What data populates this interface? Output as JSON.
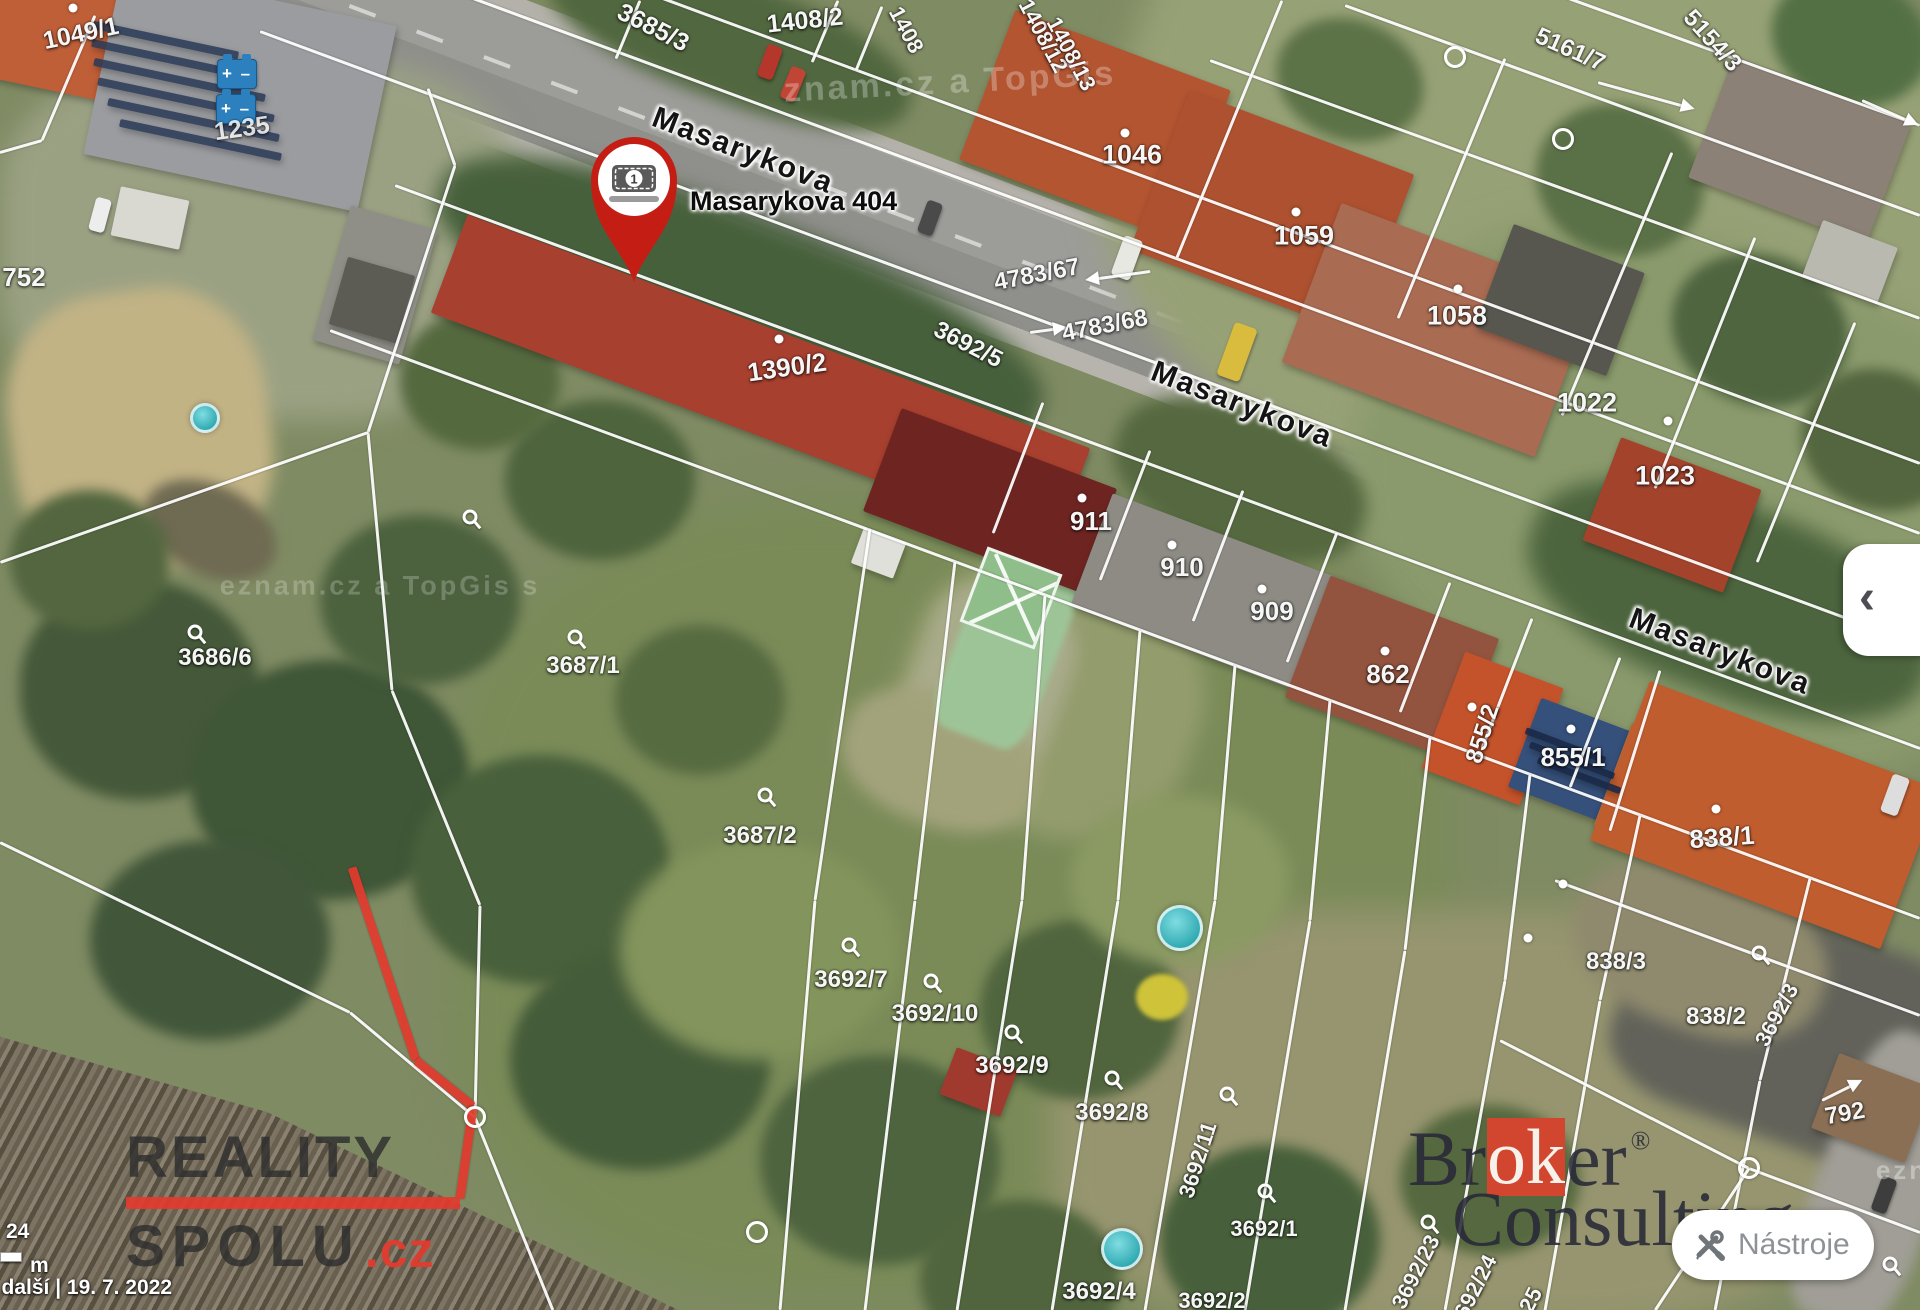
{
  "map": {
    "marker": {
      "badge": "1",
      "label": "Masarykova 404"
    },
    "street_labels": [
      {
        "t": "Masarykova",
        "x": 743,
        "y": 151,
        "r": 21,
        "s": 30
      },
      {
        "t": "Masarykova",
        "x": 1242,
        "y": 405,
        "r": 21,
        "s": 30
      },
      {
        "t": "Masarykova",
        "x": 1720,
        "y": 652,
        "r": 21,
        "s": 30
      }
    ],
    "parcel_labels": [
      {
        "t": "1049/1",
        "x": 81,
        "y": 34,
        "r": -12,
        "s": 25
      },
      {
        "t": "1235",
        "x": 242,
        "y": 129,
        "r": -8,
        "s": 25,
        "o": 0.85
      },
      {
        "t": "3685/3",
        "x": 653,
        "y": 28,
        "r": 27,
        "s": 25
      },
      {
        "t": "1408/2",
        "x": 805,
        "y": 21,
        "r": -6,
        "s": 25
      },
      {
        "t": "1408",
        "x": 906,
        "y": 30,
        "r": 62,
        "s": 22
      },
      {
        "t": "1408/12",
        "x": 1043,
        "y": 36,
        "r": 62,
        "s": 22
      },
      {
        "t": "1408/13",
        "x": 1071,
        "y": 54,
        "r": 62,
        "s": 22
      },
      {
        "t": "1046",
        "x": 1132,
        "y": 155,
        "r": 0,
        "s": 27
      },
      {
        "t": "1059",
        "x": 1304,
        "y": 236,
        "r": 0,
        "s": 27
      },
      {
        "t": "1058",
        "x": 1457,
        "y": 316,
        "r": 0,
        "s": 27
      },
      {
        "t": "1022",
        "x": 1587,
        "y": 403,
        "r": 0,
        "s": 27
      },
      {
        "t": "1023",
        "x": 1665,
        "y": 476,
        "r": 0,
        "s": 27
      },
      {
        "t": "5161/7",
        "x": 1570,
        "y": 50,
        "r": 24,
        "s": 24
      },
      {
        "t": "5154/3",
        "x": 1712,
        "y": 41,
        "r": 48,
        "s": 24
      },
      {
        "t": "752",
        "x": 24,
        "y": 277,
        "r": 0,
        "s": 26
      },
      {
        "t": "4783/67",
        "x": 1037,
        "y": 275,
        "r": -11,
        "s": 24
      },
      {
        "t": "4783/68",
        "x": 1105,
        "y": 326,
        "r": -11,
        "s": 24
      },
      {
        "t": "3692/5",
        "x": 968,
        "y": 345,
        "r": 27,
        "s": 24
      },
      {
        "t": "1390/2",
        "x": 787,
        "y": 367,
        "r": -8,
        "s": 26
      },
      {
        "t": "911",
        "x": 1091,
        "y": 521,
        "r": 0,
        "s": 26
      },
      {
        "t": "910",
        "x": 1182,
        "y": 567,
        "r": 0,
        "s": 26
      },
      {
        "t": "909",
        "x": 1272,
        "y": 611,
        "r": 0,
        "s": 26
      },
      {
        "t": "862",
        "x": 1388,
        "y": 674,
        "r": 0,
        "s": 26
      },
      {
        "t": "855/2",
        "x": 1483,
        "y": 734,
        "r": -72,
        "s": 24
      },
      {
        "t": "855/1",
        "x": 1573,
        "y": 757,
        "r": 0,
        "s": 26
      },
      {
        "t": "838/1",
        "x": 1722,
        "y": 837,
        "r": -4,
        "s": 26
      },
      {
        "t": "838/3",
        "x": 1616,
        "y": 962,
        "r": 0,
        "s": 24
      },
      {
        "t": "838/2",
        "x": 1716,
        "y": 1017,
        "r": 0,
        "s": 24
      },
      {
        "t": "3692/3",
        "x": 1777,
        "y": 1015,
        "r": -62,
        "s": 22
      },
      {
        "t": "792",
        "x": 1845,
        "y": 1114,
        "r": -10,
        "s": 24
      },
      {
        "t": "3687/1",
        "x": 583,
        "y": 666,
        "r": 0,
        "s": 24
      },
      {
        "t": "3686/6",
        "x": 215,
        "y": 658,
        "r": 0,
        "s": 24
      },
      {
        "t": "3687/2",
        "x": 760,
        "y": 836,
        "r": 0,
        "s": 24
      },
      {
        "t": "3692/7",
        "x": 851,
        "y": 980,
        "r": 0,
        "s": 24
      },
      {
        "t": "3692/10",
        "x": 935,
        "y": 1014,
        "r": 0,
        "s": 24
      },
      {
        "t": "3692/9",
        "x": 1012,
        "y": 1066,
        "r": 0,
        "s": 24
      },
      {
        "t": "3692/8",
        "x": 1112,
        "y": 1113,
        "r": 0,
        "s": 24
      },
      {
        "t": "3692/11",
        "x": 1198,
        "y": 1160,
        "r": -72,
        "s": 22
      },
      {
        "t": "3692/1",
        "x": 1264,
        "y": 1229,
        "r": 0,
        "s": 22
      },
      {
        "t": "3692/4",
        "x": 1099,
        "y": 1292,
        "r": 0,
        "s": 24
      },
      {
        "t": "3692/23",
        "x": 1416,
        "y": 1272,
        "r": -63,
        "s": 22
      },
      {
        "t": "3692/24",
        "x": 1473,
        "y": 1292,
        "r": -63,
        "s": 22
      },
      {
        "t": "25",
        "x": 1531,
        "y": 1300,
        "r": -63,
        "s": 22
      },
      {
        "t": "3692/2",
        "x": 1212,
        "y": 1301,
        "r": 0,
        "s": 22
      }
    ],
    "watermarks": [
      {
        "t": "znam.cz a TopGis",
        "x": 950,
        "y": 82,
        "r": -3,
        "s": 34,
        "o": 0.28
      },
      {
        "t": "eznam.cz a TopGis s",
        "x": 380,
        "y": 586,
        "r": 0,
        "s": 27,
        "o": 0.22
      },
      {
        "t": "ezn",
        "x": 1902,
        "y": 1170,
        "r": 0,
        "s": 26,
        "o": 0.35
      }
    ],
    "poi": {
      "battery_symbol": "+ –",
      "positions": [
        {
          "x": 237,
          "y": 74
        },
        {
          "x": 236,
          "y": 109
        }
      ]
    }
  },
  "branding": {
    "reality_line1": "REALITY",
    "reality_line2": "SPOLU",
    "reality_tld": ".cz",
    "broker_pre": "Br",
    "broker_mid": "ok",
    "broker_post": "er",
    "broker_reg": "®",
    "broker_line2": "Consulting"
  },
  "controls": {
    "tools_button": "Nástroje",
    "collapse_chevron": "‹"
  },
  "statusbar": {
    "scale_value": "24",
    "scale_unit": "m",
    "attribution": "a další | 19. 7. 2022"
  },
  "colors": {
    "accent_red": "#e23b2e",
    "broker_red": "#d2452e",
    "marker_red": "#c41e14",
    "battery_blue": "#2c80bd"
  }
}
